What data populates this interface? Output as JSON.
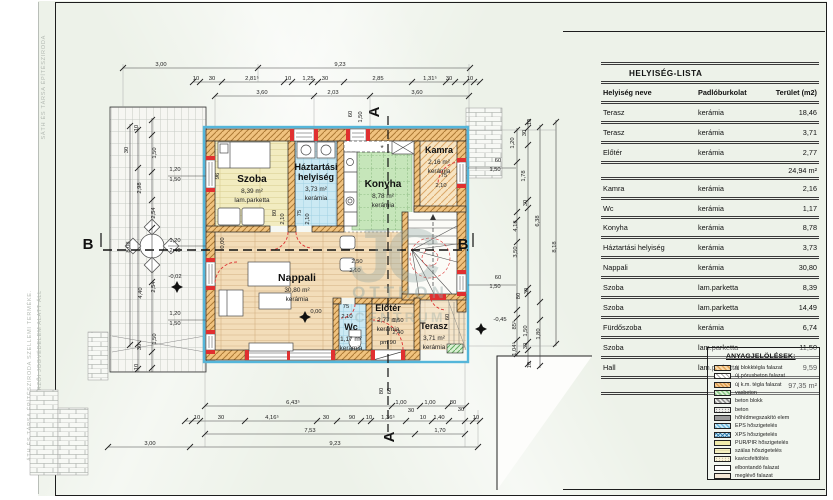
{
  "sheet": {
    "copyright_vertical_1": "SÁTH ÉS TÁRSA ÉPÍTÉSZIRODA",
    "copyright_vertical_2": "ÁTH ÉS TÁRSA ÉPÍTÉSZIRODA SZELLEMI TERMÉKE.",
    "copyright_vertical_3": "RVÉNY ÉRTELMÉBEN SZERZŐI JOGVÉDELEM ALATT ÁLL"
  },
  "watermark": {
    "initials": "JC",
    "line1": "OTTHON",
    "line2": "CENTRUM"
  },
  "room_table": {
    "title": "HELYISÉG-LISTA",
    "columns": [
      "Helyiség neve",
      "Padlóburkolat",
      "Terület (m2)"
    ],
    "rows": [
      {
        "name": "Terasz",
        "floor": "kerámia",
        "area": "18,46"
      },
      {
        "name": "Terasz",
        "floor": "kerámia",
        "area": "3,71"
      },
      {
        "name": "Előtér",
        "floor": "kerámia",
        "area": "2,77"
      },
      {
        "subtotal": "24,94 m²"
      },
      {
        "name": "Kamra",
        "floor": "kerámia",
        "area": "2,16"
      },
      {
        "name": "Wc",
        "floor": "kerámia",
        "area": "1,17"
      },
      {
        "name": "Konyha",
        "floor": "kerámia",
        "area": "8,78"
      },
      {
        "name": "Háztartási helyiség",
        "floor": "kerámia",
        "area": "3,73"
      },
      {
        "name": "Nappali",
        "floor": "kerámia",
        "area": "30,80"
      },
      {
        "name": "Szoba",
        "floor": "lam.parketta",
        "area": "8,39"
      },
      {
        "name": "Szoba",
        "floor": "lam.parketta",
        "area": "14,49"
      },
      {
        "name": "Fürdőszoba",
        "floor": "kerámia",
        "area": "6,74"
      },
      {
        "name": "Szoba",
        "floor": "lam.parketta",
        "area": "11,50"
      },
      {
        "name": "Hall",
        "floor": "lam.parketta",
        "area": "9,59"
      },
      {
        "subtotal": "97,35 m²"
      }
    ]
  },
  "legend": {
    "title": "ANYAGJELÖLÉSEK:",
    "items": [
      {
        "label": "új blokktégla falazat",
        "style": "brick-new"
      },
      {
        "label": "új pórusbeton falazat",
        "style": "porous"
      },
      {
        "label": "új k.m. tégla falazat",
        "style": "small-brick"
      },
      {
        "label": "vasbeton",
        "style": "rc"
      },
      {
        "label": "beton blokk",
        "style": "concrete-block"
      },
      {
        "label": "beton",
        "style": "concrete"
      },
      {
        "label": "hőhídmegszakító elem",
        "style": "thermal-break"
      },
      {
        "label": "EPS hőszigetelés",
        "style": "eps"
      },
      {
        "label": "XPS hőszigetelés",
        "style": "xps"
      },
      {
        "label": "PUR/PIR hőszigetelés",
        "style": "purpir"
      },
      {
        "label": "szálas hőszigetelés",
        "style": "fiber"
      },
      {
        "label": "kavicsfeltöltés",
        "style": "gravel"
      },
      {
        "label": "elbontandó falazat",
        "style": "demolish"
      },
      {
        "label": "meglévő falazat",
        "style": "existing"
      }
    ]
  },
  "plan": {
    "section_markers": {
      "a": "A",
      "b": "B"
    },
    "rooms": [
      {
        "name": "Szoba",
        "area": "8,39 m²",
        "floor": "lam.parketta",
        "x": 252,
        "y": 182,
        "fs": 10
      },
      {
        "name": "Háztartási",
        "name2": "helyiség",
        "area": "3,73 m²",
        "floor": "kerámia",
        "x": 316,
        "y": 170,
        "fs": 9
      },
      {
        "name": "Konyha",
        "area": "8,78 m²",
        "floor": "kerámia",
        "x": 383,
        "y": 187,
        "fs": 10
      },
      {
        "name": "Kamra",
        "area": "2,16 m²",
        "floor": "kerámia",
        "x": 439,
        "y": 153,
        "fs": 9
      },
      {
        "name": "Nappali",
        "area": "30,80 m²",
        "floor": "kerámia",
        "x": 297,
        "y": 281,
        "fs": 10.5
      },
      {
        "name": "Wc",
        "area": "1,17 m²",
        "floor": "kerámia",
        "x": 351,
        "y": 330,
        "fs": 9
      },
      {
        "name": "Előtér",
        "area": "2,77 m²",
        "floor": "kerámia",
        "x": 388,
        "y": 311,
        "fs": 9
      },
      {
        "name": "Terasz",
        "area": "3,71 m²",
        "floor": "kerámia",
        "x": 434,
        "y": 329,
        "fs": 9
      }
    ],
    "dimension_labels": [
      {
        "t": "3,00",
        "x": 161,
        "y": 66
      },
      {
        "t": "9,23",
        "x": 340,
        "y": 66
      },
      {
        "t": "10",
        "x": 196,
        "y": 80
      },
      {
        "t": "30",
        "x": 212,
        "y": 80
      },
      {
        "t": "2,81⁵",
        "x": 252,
        "y": 80
      },
      {
        "t": "10",
        "x": 288,
        "y": 80
      },
      {
        "t": "1,25",
        "x": 308,
        "y": 80
      },
      {
        "t": "30",
        "x": 325,
        "y": 80
      },
      {
        "t": "2,85",
        "x": 378,
        "y": 80
      },
      {
        "t": "1,31⁵",
        "x": 430,
        "y": 80
      },
      {
        "t": "30",
        "x": 449,
        "y": 80
      },
      {
        "t": "10",
        "x": 470,
        "y": 80
      },
      {
        "t": "3,60",
        "x": 262,
        "y": 94
      },
      {
        "t": "2,03",
        "x": 333,
        "y": 94
      },
      {
        "t": "3,60",
        "x": 417,
        "y": 94
      },
      {
        "t": "60",
        "x": 352,
        "y": 114,
        "r": 1
      },
      {
        "t": "1,50",
        "x": 362,
        "y": 117,
        "r": 1
      },
      {
        "t": "10",
        "x": 531,
        "y": 122,
        "r": 1
      },
      {
        "t": "30",
        "x": 526,
        "y": 133,
        "r": 1
      },
      {
        "t": "1,20",
        "x": 514,
        "y": 143,
        "r": 1
      },
      {
        "t": "60",
        "x": 498,
        "y": 162
      },
      {
        "t": "1,50",
        "x": 495,
        "y": 171
      },
      {
        "t": "1,78",
        "x": 525,
        "y": 176,
        "r": 1
      },
      {
        "t": "30",
        "x": 527,
        "y": 203,
        "r": 1
      },
      {
        "t": "4,18",
        "x": 517,
        "y": 226,
        "r": 1
      },
      {
        "t": "6,38",
        "x": 539,
        "y": 221,
        "r": 1
      },
      {
        "t": "8,18",
        "x": 556,
        "y": 247,
        "r": 1
      },
      {
        "t": "3,50",
        "x": 517,
        "y": 252,
        "r": 1
      },
      {
        "t": "60",
        "x": 498,
        "y": 279
      },
      {
        "t": "1,50",
        "x": 495,
        "y": 288
      },
      {
        "t": "80",
        "x": 520,
        "y": 296,
        "r": 1
      },
      {
        "t": "30",
        "x": 528,
        "y": 291,
        "r": 1
      },
      {
        "t": "-0,45",
        "x": 500,
        "y": 321
      },
      {
        "t": "85⁵",
        "x": 516,
        "y": 325,
        "r": 1
      },
      {
        "t": "1,50",
        "x": 527,
        "y": 331,
        "r": 1
      },
      {
        "t": "1,80",
        "x": 540,
        "y": 334,
        "r": 1
      },
      {
        "t": "1,04⁵",
        "x": 516,
        "y": 349,
        "r": 1
      },
      {
        "t": "30",
        "x": 527,
        "y": 346,
        "r": 1
      },
      {
        "t": "10",
        "x": 531,
        "y": 365,
        "r": 1
      },
      {
        "t": "10",
        "x": 138,
        "y": 128,
        "r": 1
      },
      {
        "t": "30",
        "x": 128,
        "y": 150,
        "r": 1
      },
      {
        "t": "1,50",
        "x": 156,
        "y": 153,
        "r": 1
      },
      {
        "t": "1,20",
        "x": 175,
        "y": 171
      },
      {
        "t": "1,50",
        "x": 175,
        "y": 181
      },
      {
        "t": "2,98",
        "x": 141,
        "y": 188,
        "r": 1
      },
      {
        "t": "2,54",
        "x": 155,
        "y": 213,
        "r": 1
      },
      {
        "t": "8,08",
        "x": 130,
        "y": 247,
        "r": 1
      },
      {
        "t": "1,20",
        "x": 175,
        "y": 242
      },
      {
        "t": "2,40",
        "x": 175,
        "y": 252
      },
      {
        "t": "-0,02",
        "x": 175,
        "y": 278
      },
      {
        "t": "2,54",
        "x": 155,
        "y": 287,
        "r": 1
      },
      {
        "t": "4,40",
        "x": 142,
        "y": 293,
        "r": 1
      },
      {
        "t": "1,20",
        "x": 175,
        "y": 315
      },
      {
        "t": "1,50",
        "x": 175,
        "y": 325
      },
      {
        "t": "1,50",
        "x": 156,
        "y": 339,
        "r": 1
      },
      {
        "t": "30",
        "x": 141,
        "y": 347,
        "r": 1
      },
      {
        "t": "10",
        "x": 138,
        "y": 367,
        "r": 1
      },
      {
        "t": "6,43⁵",
        "x": 293,
        "y": 404
      },
      {
        "t": "1,00",
        "x": 401,
        "y": 404
      },
      {
        "t": "1,00",
        "x": 430,
        "y": 404
      },
      {
        "t": "80",
        "x": 453,
        "y": 404
      },
      {
        "t": "30",
        "x": 411,
        "y": 412
      },
      {
        "t": "30",
        "x": 461,
        "y": 411
      },
      {
        "t": "10",
        "x": 197,
        "y": 419
      },
      {
        "t": "30",
        "x": 221,
        "y": 419
      },
      {
        "t": "4,16⁵",
        "x": 272,
        "y": 419
      },
      {
        "t": "30",
        "x": 326,
        "y": 419
      },
      {
        "t": "90",
        "x": 352,
        "y": 419
      },
      {
        "t": "10",
        "x": 369,
        "y": 419
      },
      {
        "t": "1,36⁵",
        "x": 388,
        "y": 419
      },
      {
        "t": "10",
        "x": 423,
        "y": 419
      },
      {
        "t": "1,40",
        "x": 439,
        "y": 419
      },
      {
        "t": "10",
        "x": 476,
        "y": 419
      },
      {
        "t": "7,53",
        "x": 310,
        "y": 432
      },
      {
        "t": "1,70",
        "x": 440,
        "y": 432
      },
      {
        "t": "3,00",
        "x": 150,
        "y": 445
      },
      {
        "t": "9,23",
        "x": 335,
        "y": 445
      },
      {
        "t": "80",
        "x": 383,
        "y": 391,
        "r": 1
      },
      {
        "t": "60",
        "x": 391,
        "y": 391,
        "r": 1
      },
      {
        "t": "96",
        "x": 219,
        "y": 176,
        "r": 1
      },
      {
        "t": "80",
        "x": 276,
        "y": 213,
        "r": 1
      },
      {
        "t": "2,10",
        "x": 284,
        "y": 219,
        "r": 1
      },
      {
        "t": "75",
        "x": 301,
        "y": 213,
        "r": 1
      },
      {
        "t": "2,10",
        "x": 309,
        "y": 219,
        "r": 1
      },
      {
        "t": "75",
        "x": 444,
        "y": 177
      },
      {
        "t": "2,10",
        "x": 441,
        "y": 187
      },
      {
        "t": "2,50",
        "x": 357,
        "y": 263
      },
      {
        "t": "2,10",
        "x": 355,
        "y": 272
      },
      {
        "t": "75",
        "x": 346,
        "y": 308
      },
      {
        "t": "2,10",
        "x": 347,
        "y": 318
      },
      {
        "t": "1,50",
        "x": 398,
        "y": 322
      },
      {
        "t": "2,40",
        "x": 398,
        "y": 334
      },
      {
        "t": "pm 90",
        "x": 388,
        "y": 344
      },
      {
        "t": "0,00",
        "x": 316,
        "y": 313
      },
      {
        "t": "0,00",
        "x": 224,
        "y": 243,
        "r": 1
      },
      {
        "t": "60",
        "x": 449,
        "y": 317,
        "r": 1
      }
    ]
  }
}
